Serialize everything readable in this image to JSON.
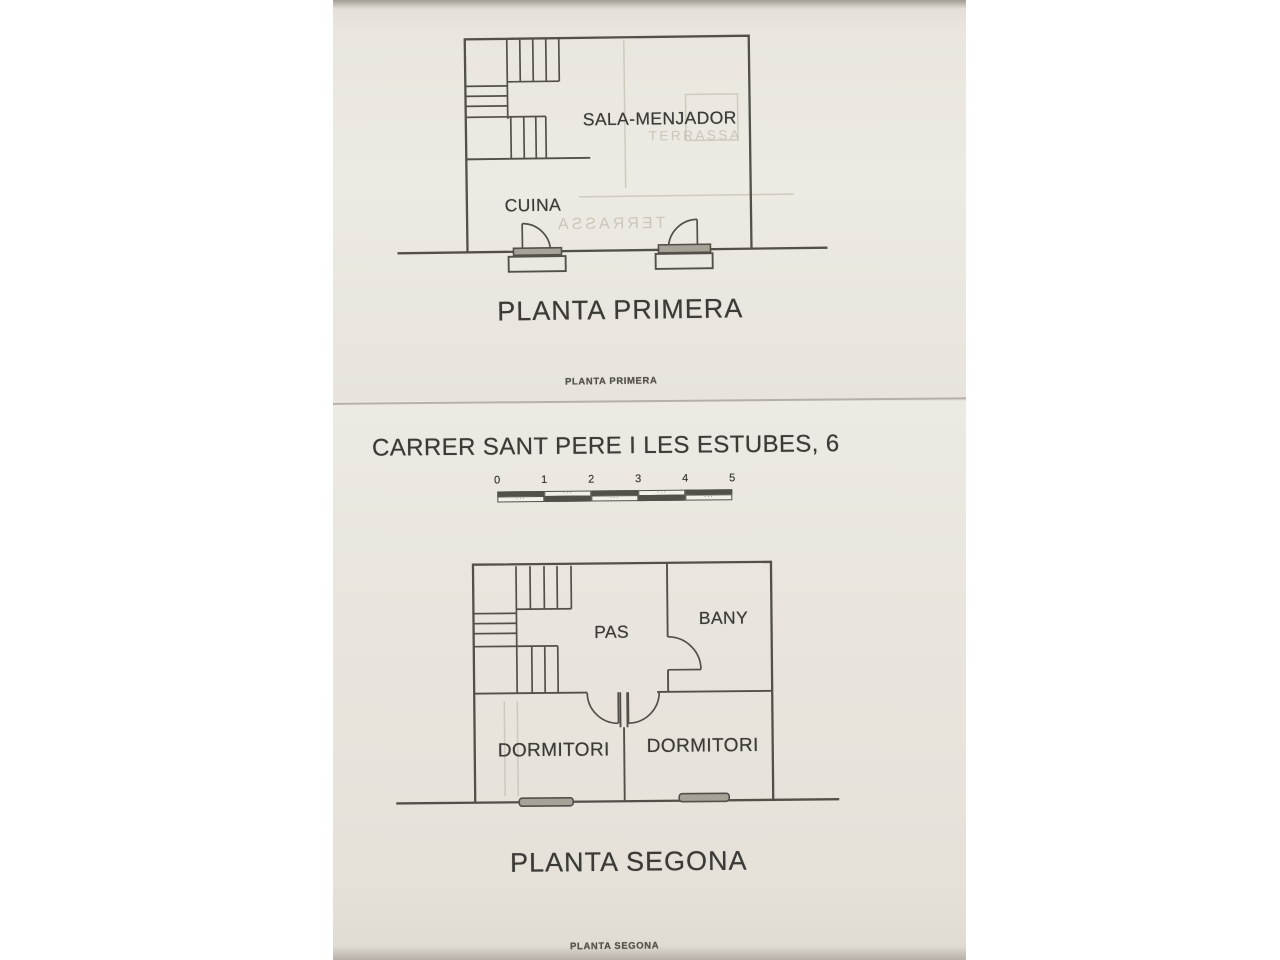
{
  "photo": {
    "colors": {
      "paper": "#e9e5de",
      "line": "#53504a",
      "text": "#3c3a36",
      "ghost": "#c6c0b2",
      "threshold": "#a7a298"
    },
    "page1": {
      "rooms": {
        "sala": "SALA-MENJADOR",
        "cuina": "CUINA"
      },
      "ghosts": {
        "terrassa_a": "TERRASSA",
        "terrassa_b": "TERRASSA"
      },
      "title": "PLANTA PRIMERA",
      "caption": "PLANTA PRIMERA"
    },
    "page2": {
      "address": "CARRER SANT PERE I LES ESTUBES, 6",
      "scalebar": {
        "labels": [
          "0",
          "1",
          "2",
          "3",
          "4",
          "5"
        ]
      },
      "rooms": {
        "pas": "PAS",
        "bany": "BANY",
        "dormitori_left": "DORMITORI",
        "dormitori_right": "DORMITORI"
      },
      "title": "PLANTA SEGONA",
      "caption": "PLANTA SEGONA"
    }
  }
}
